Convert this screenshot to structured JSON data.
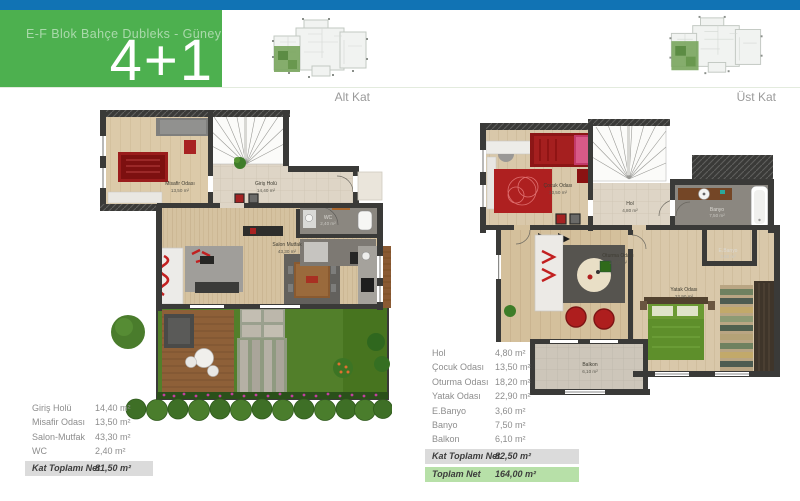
{
  "header": {
    "title": "E-F Blok Bahçe Dubleks - Güney Ön",
    "unit_type": "4+1"
  },
  "colors": {
    "top_bar": "#1173b4",
    "header_box": "#4db04f",
    "total_bar_gray": "#dbdbdb",
    "total_bar_green": "#b7e0a8"
  },
  "floor_labels": {
    "left": "Alt Kat",
    "right": "Üst Kat"
  },
  "alt_kat_plan": {
    "rooms": [
      {
        "name": "Misafir Odası",
        "area": "13,50 m²"
      },
      {
        "name": "Giriş Holü",
        "area": "14,40 m²"
      },
      {
        "name": "WC",
        "area": "2,40 m²"
      },
      {
        "name": "Salon Mutfak",
        "area": "43,30 m²"
      }
    ]
  },
  "ust_kat_plan": {
    "rooms": [
      {
        "name": "Çocuk Odası",
        "area": "13,50 m²"
      },
      {
        "name": "Hol",
        "area": "4,80 m²"
      },
      {
        "name": "Banyo",
        "area": "7,50 m²"
      },
      {
        "name": "E.Banyo",
        "area": "3,60 m²"
      },
      {
        "name": "Oturma Odası",
        "area": "18,20 m²"
      },
      {
        "name": "Yatak Odası",
        "area": "22,90 m²"
      },
      {
        "name": "Balkon",
        "area": "6,10 m²"
      }
    ]
  },
  "alt_kat_table": {
    "rows": [
      {
        "label": "Giriş Holü",
        "value": "14,40 m²"
      },
      {
        "label": "Misafir Odası",
        "value": "13,50 m²"
      },
      {
        "label": "Salon-Mutfak",
        "value": "43,30 m²"
      },
      {
        "label": "WC",
        "value": "2,40 m²"
      }
    ],
    "total": {
      "label": "Kat Toplamı Net",
      "value": "81,50  m²"
    }
  },
  "ust_kat_table": {
    "rows": [
      {
        "label": "Hol",
        "value": "4,80 m²"
      },
      {
        "label": "Çocuk Odası",
        "value": "13,50 m²"
      },
      {
        "label": "Oturma  Odası",
        "value": "18,20 m²"
      },
      {
        "label": "Yatak Odası",
        "value": "22,90 m²"
      },
      {
        "label": "E.Banyo",
        "value": "3,60 m²"
      },
      {
        "label": "Banyo",
        "value": "7,50 m²"
      },
      {
        "label": "Balkon",
        "value": "6,10 m²"
      }
    ],
    "floor_total": {
      "label": "Kat Toplamı Net",
      "value": "82,50  m²"
    },
    "grand_total": {
      "label": "Toplam Net",
      "value": "164,00  m²"
    }
  }
}
